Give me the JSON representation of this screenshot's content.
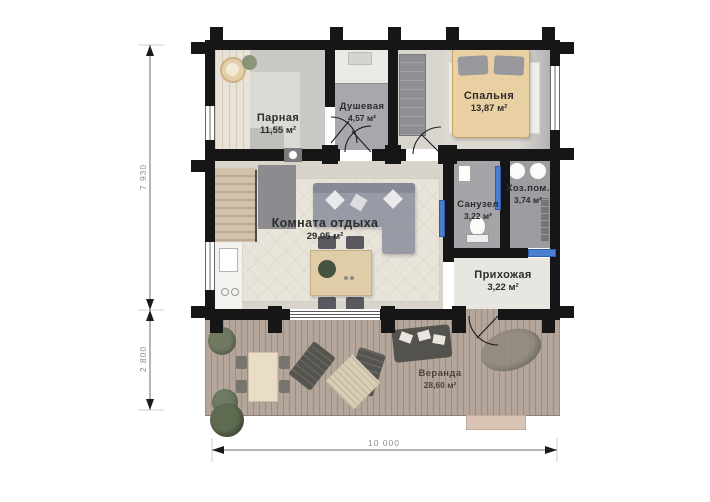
{
  "plan_title": "floor-plan-banya",
  "rooms": [
    {
      "name": "Парная",
      "area": "11,55 м²"
    },
    {
      "name": "Душевая",
      "area": "4,57 м²"
    },
    {
      "name": "Спальня",
      "area": "13,87 м²"
    },
    {
      "name": "Санузел",
      "area": "3,22 м²"
    },
    {
      "name": "Хоз.пом.",
      "area": "3,74 м²"
    },
    {
      "name": "Комната отдыха",
      "area": "29,05 м²"
    },
    {
      "name": "Прихожая",
      "area": "3,22 м²"
    },
    {
      "name": "Веранда",
      "area": "28,60 м²"
    }
  ],
  "dimensions": {
    "left_top": "7 930",
    "left_bottom": "2 800",
    "bottom": "10 000"
  },
  "colors": {
    "wall": "#161616",
    "sliding_door_accent": "#4a7fd0",
    "deck": "#b4a69b",
    "bed": "#e9d0a2",
    "sofa": "#989aa5",
    "dimension_text": "#8c8c8c"
  }
}
